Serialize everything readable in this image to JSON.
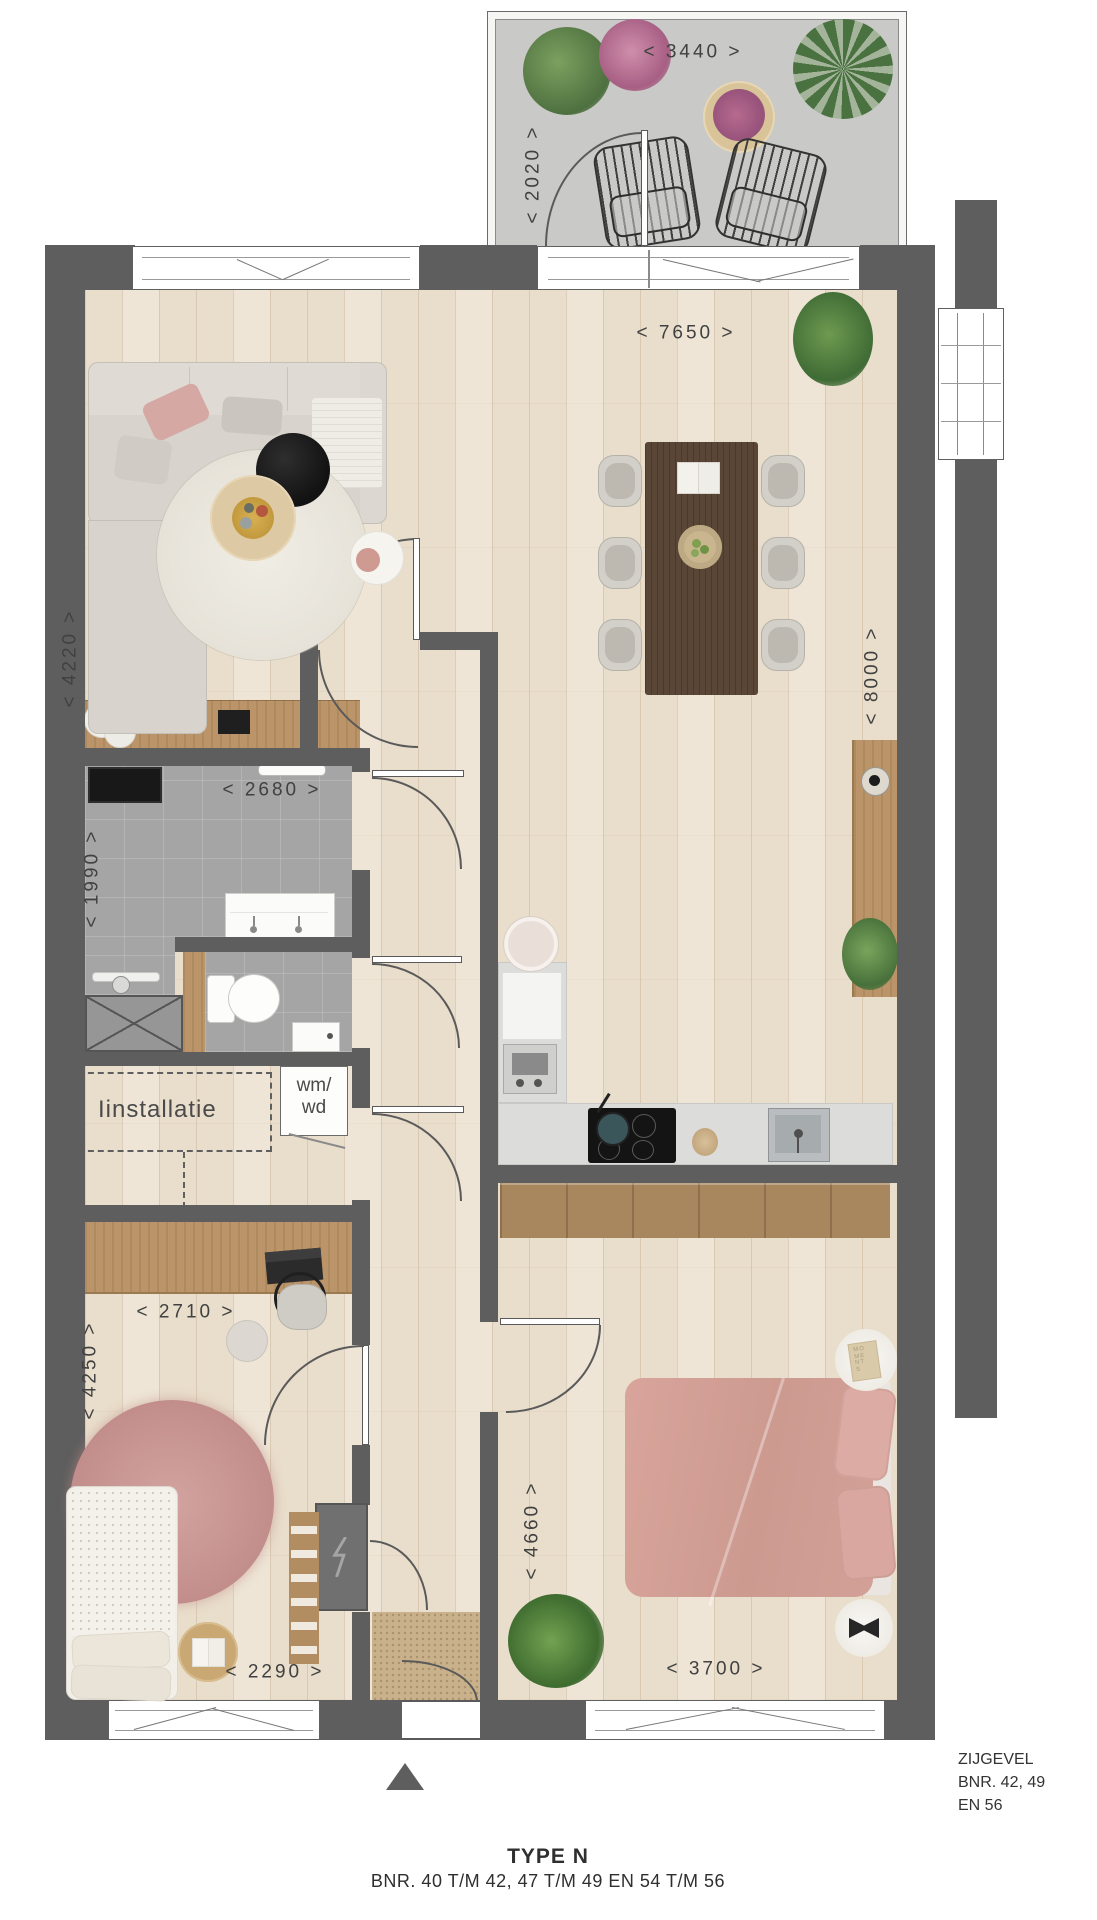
{
  "title": {
    "type": "TYPE N",
    "bnr": "BNR. 40 T/M 42, 47 T/M 49 EN 54 T/M 56"
  },
  "side_wall_label": {
    "line1": "ZIJGEVEL",
    "line2": "BNR. 42, 49",
    "line3": "EN 56"
  },
  "dimensions": {
    "balcony_width": "< 3440 >",
    "balcony_depth": "< 2020 >",
    "living_dining_width": "< 7650 >",
    "living_depth": "< 4220 >",
    "main_area_depth": "< 8000 >",
    "bathroom_width": "< 2680 >",
    "bathroom_depth": "< 1990 >",
    "bedroom2_width": "< 2710 >",
    "bedroom2_depth": "< 4250 >",
    "bedroom1_depth": "< 4660 >",
    "bedroom1_width": "< 3700 >",
    "bedroom2_lower_width": "< 2290 >"
  },
  "room_labels": {
    "installation": "Iinstallatie",
    "washer_line1": "wm/",
    "washer_line2": "wd"
  },
  "decor_labels": {
    "book": "MOMENTS"
  },
  "colors": {
    "wall": "#5e5e5e",
    "wood_floor": "#e9decb",
    "tile_floor": "#a5a5a5",
    "balcony_floor": "#c9c9c7",
    "bed_pink": "#d29d94",
    "rug_pink": "#cc9b98",
    "dining_table_wood": "#5a4636",
    "kitchen_counter": "#dcdcda"
  }
}
